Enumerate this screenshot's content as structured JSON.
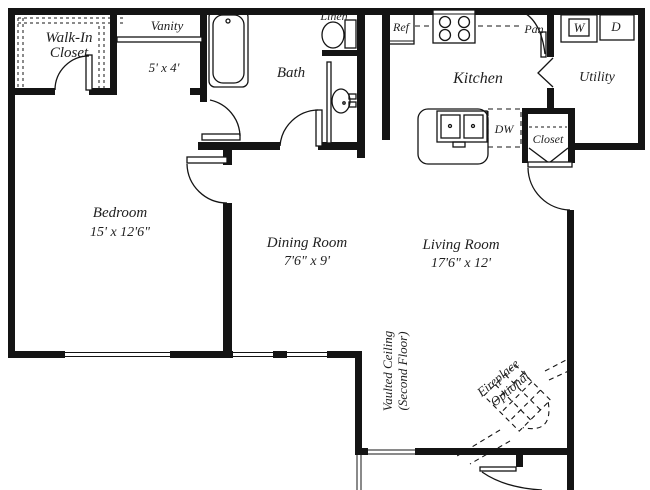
{
  "colors": {
    "wall": "#141414",
    "ink": "#1f1f1f",
    "background": "#ffffff"
  },
  "rooms": {
    "walk_in_closet": {
      "line1": "Walk-In",
      "line2": "Closet"
    },
    "vanity": {
      "label": "Vanity",
      "dims": "5' x 4'"
    },
    "bath": {
      "label": "Bath"
    },
    "linen": {
      "label": "Linen"
    },
    "bedroom": {
      "label": "Bedroom",
      "dims": "15' x 12'6\""
    },
    "dining_room": {
      "label": "Dining Room",
      "dims": "7'6\" x 9'"
    },
    "living_room": {
      "label": "Living Room",
      "dims": "17'6\" x 12'"
    },
    "kitchen": {
      "label": "Kitchen"
    },
    "utility": {
      "label": "Utility"
    },
    "pantry": {
      "label": "Pan"
    },
    "entry_closet": {
      "label": "Closet"
    },
    "vaulted_ceiling": {
      "line1": "Vaulted Ceiling",
      "line2": "(Second Floor)"
    },
    "fireplace": {
      "line1": "Fireplace",
      "line2": "Optional"
    }
  },
  "appliances": {
    "refrigerator": "Ref",
    "dishwasher": "DW",
    "washer": "W",
    "dryer": "D"
  }
}
